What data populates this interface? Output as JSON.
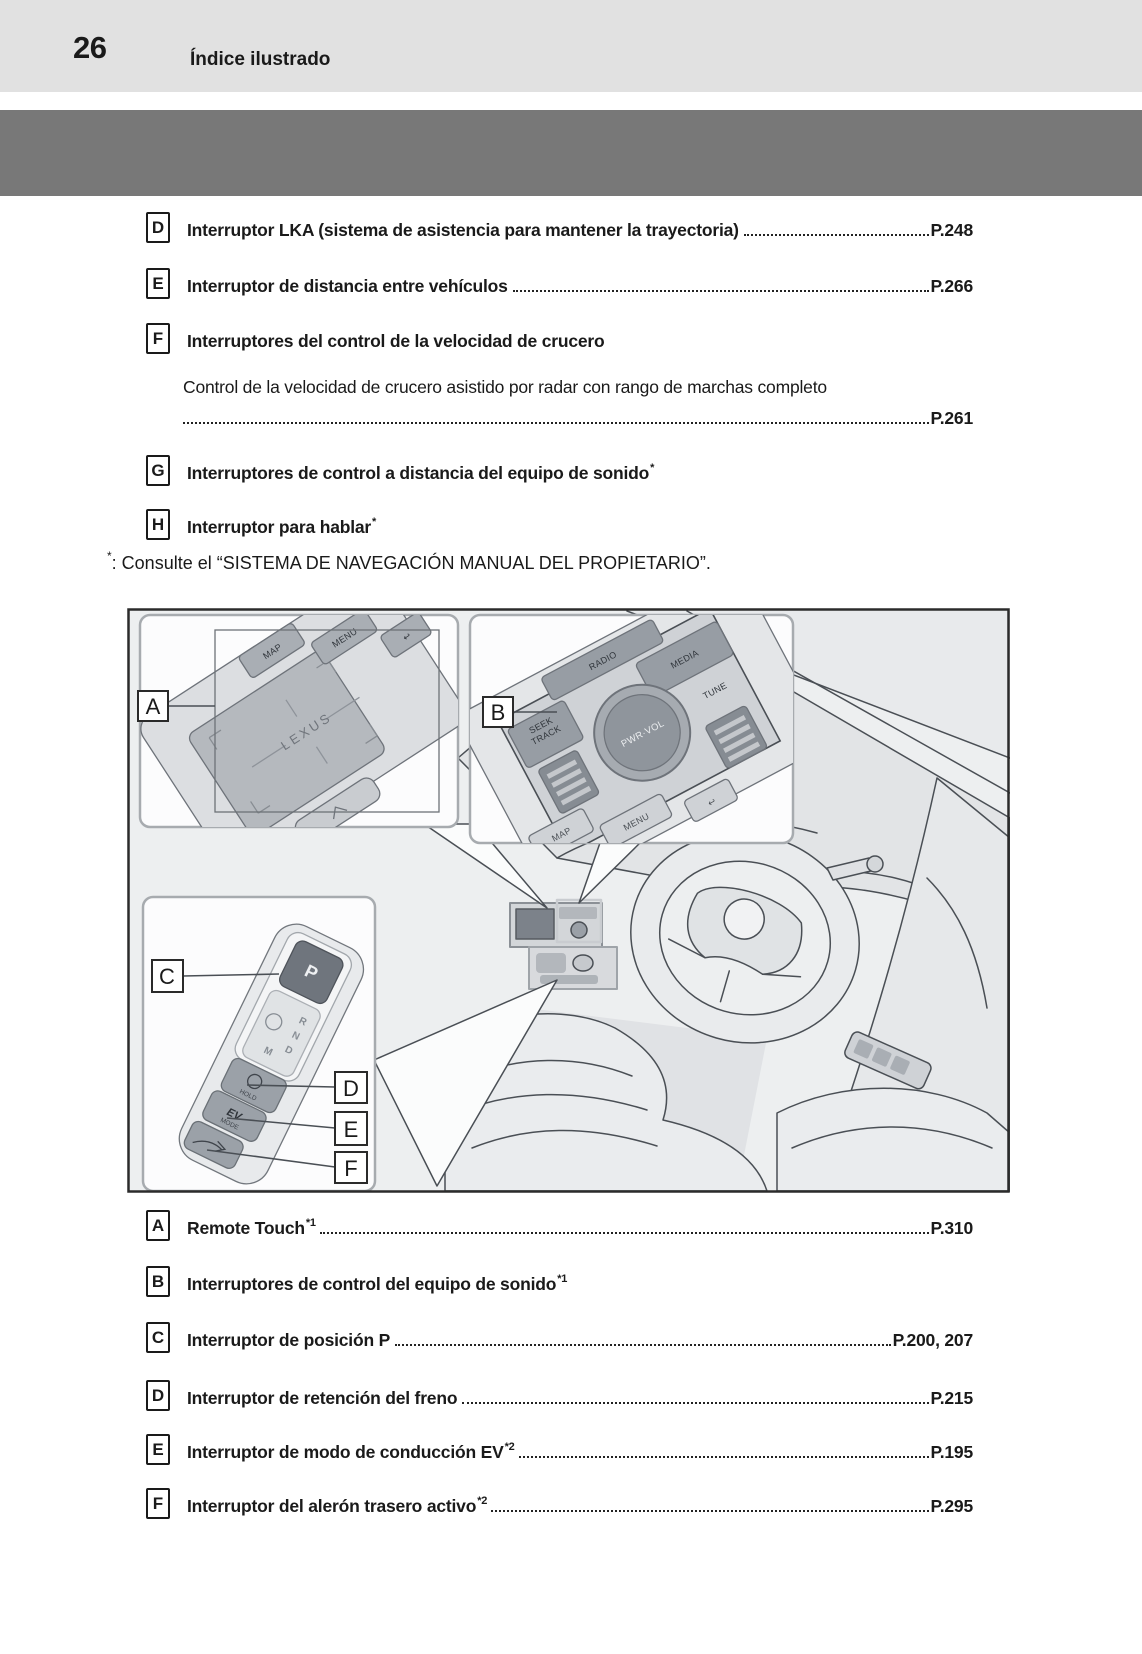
{
  "header": {
    "page_number": "26",
    "title": "Índice ilustrado"
  },
  "colors": {
    "header_band": "#e1e1e1",
    "section_banner": "#787878",
    "text": "#1a1a1a",
    "illustration_line": "#4a4f55"
  },
  "top_list": [
    {
      "key": "D",
      "label": "Interruptor LKA (sistema de asistencia para mantener la trayectoria)",
      "sup": "",
      "page_ref": "P.248"
    },
    {
      "key": "E",
      "label": "Interruptor de distancia entre vehículos",
      "sup": "",
      "page_ref": "P.266"
    },
    {
      "key": "F",
      "label": "Interruptores del control de la velocidad de crucero",
      "sup": "",
      "page_ref": ""
    },
    {
      "key": "G",
      "label": "Interruptores de control a distancia del equipo de sonido",
      "sup": "*",
      "page_ref": ""
    },
    {
      "key": "H",
      "label": "Interruptor para hablar",
      "sup": "*",
      "page_ref": ""
    }
  ],
  "top_list_sub": {
    "text": "Control de la velocidad de crucero asistido por radar con rango de marchas completo",
    "page_ref": "P.261"
  },
  "footnote": {
    "marker": "*",
    "text": ": Consulte el “SISTEMA DE NAVEGACIÓN MANUAL DEL PROPIETARIO”."
  },
  "illustration": {
    "callouts": {
      "a": "A",
      "b": "B",
      "c": "C",
      "d": "D",
      "e": "E",
      "f": "F"
    },
    "inset_a": {
      "map_button": "MAP",
      "menu_button": "MENU",
      "back_icon": "↩",
      "touchpad_logo": "LEXUS"
    },
    "inset_b": {
      "radio_button": "RADIO",
      "seek_label": "SEEK",
      "track_label": "TRACK",
      "media_button": "MEDIA",
      "volume_knob": "PWR·VOL",
      "tune_label": "TUNE",
      "map_button": "MAP",
      "menu_button": "MENU",
      "back_icon": "↩"
    },
    "inset_c": {
      "park_button": "P",
      "gear_r": "R",
      "gear_n": "N",
      "gear_d": "D",
      "gear_m": "M",
      "hold_button": "HOLD",
      "ev_label": "EV",
      "ev_mode_label": "MODE"
    }
  },
  "bottom_list": [
    {
      "key": "A",
      "label": "Remote Touch",
      "sup": "*1",
      "page_ref": "P.310"
    },
    {
      "key": "B",
      "label": "Interruptores de control del equipo de sonido",
      "sup": "*1",
      "page_ref": ""
    },
    {
      "key": "C",
      "label": "Interruptor de posición P",
      "sup": "",
      "page_ref": "P.200, 207"
    },
    {
      "key": "D",
      "label": "Interruptor de retención del freno",
      "sup": "",
      "page_ref": "P.215"
    },
    {
      "key": "E",
      "label": "Interruptor de modo de conducción EV",
      "sup": "*2",
      "page_ref": "P.195"
    },
    {
      "key": "F",
      "label": "Interruptor del alerón trasero activo",
      "sup": "*2",
      "page_ref": "P.295"
    }
  ]
}
